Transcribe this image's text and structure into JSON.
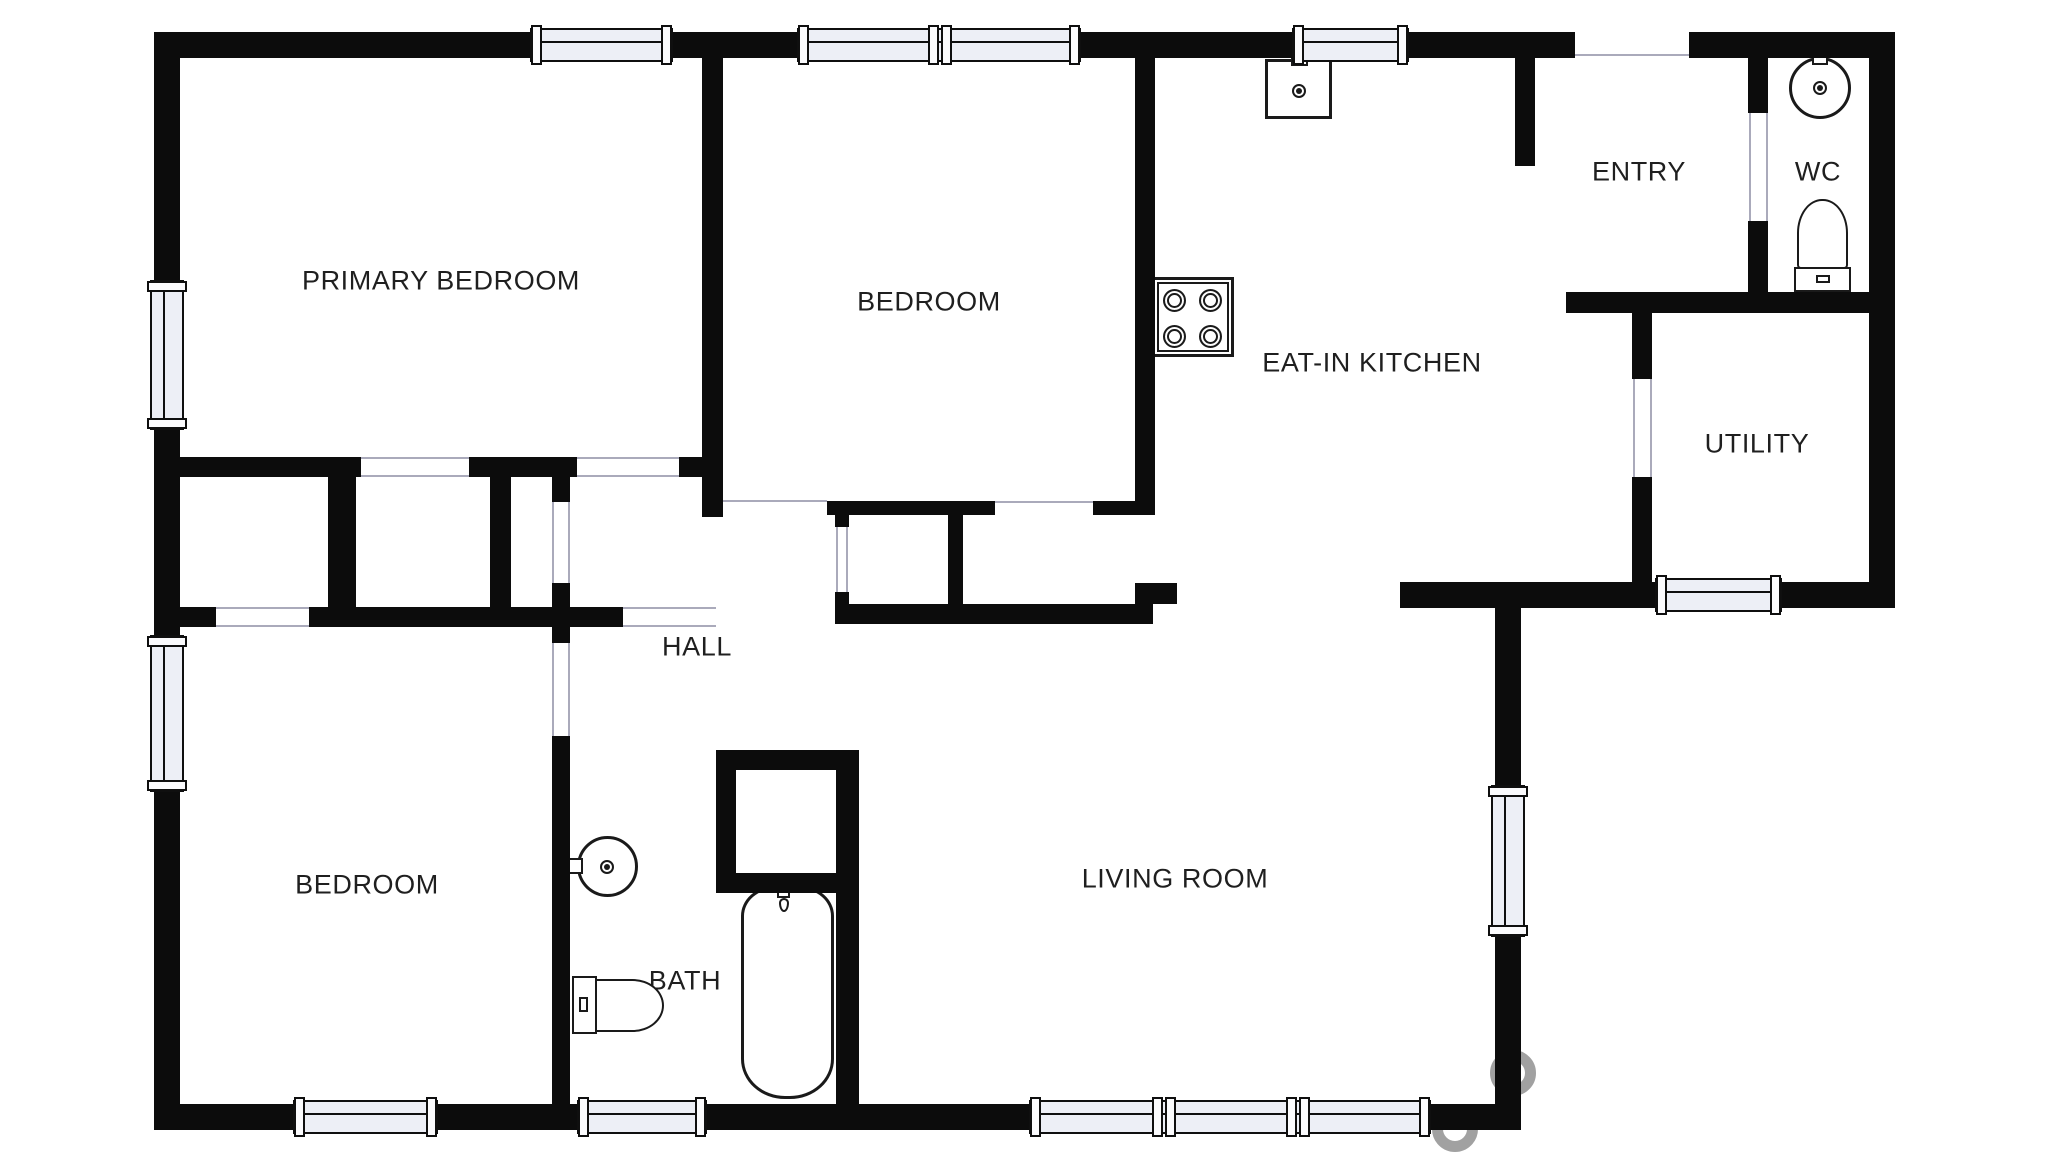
{
  "plan": {
    "title": "floor-plan",
    "rooms": [
      {
        "id": "primary-bedroom",
        "label": "PRIMARY BEDROOM"
      },
      {
        "id": "bedroom-top",
        "label": "BEDROOM"
      },
      {
        "id": "eat-in-kitchen",
        "label": "EAT-IN KITCHEN"
      },
      {
        "id": "entry",
        "label": "ENTRY"
      },
      {
        "id": "wc",
        "label": "WC"
      },
      {
        "id": "utility",
        "label": "UTILITY"
      },
      {
        "id": "hall",
        "label": "HALL"
      },
      {
        "id": "bedroom-bottom",
        "label": "BEDROOM"
      },
      {
        "id": "bath",
        "label": "BATH"
      },
      {
        "id": "living-room",
        "label": "LIVING ROOM"
      }
    ],
    "fixtures": [
      "kitchen-sink",
      "stove-cooktop",
      "wc-sink",
      "wc-toilet",
      "bath-sink",
      "bath-toilet",
      "bathtub"
    ],
    "colors": {
      "wall": "#0c0c0c",
      "window_fill": "#edeff6",
      "opening_line": "#aaaabb",
      "label_text": "#1f1f1f",
      "watermark": "#7d7d7d"
    }
  }
}
